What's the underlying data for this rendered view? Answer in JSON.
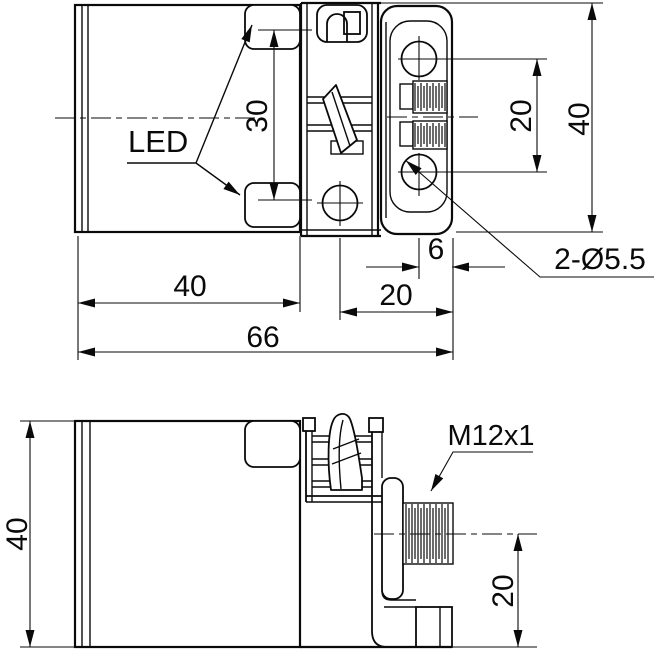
{
  "drawing": {
    "type": "sensor-dimensional-drawing",
    "ink_color": "#0a0a0a",
    "paper_color": "#ffffff",
    "top_view": {
      "led_label": "LED",
      "dims": {
        "led_spacing": "30",
        "hole_spacing": "20",
        "overall_height": "40",
        "hole_edge_offset": "6",
        "bracket_length": "20",
        "body_length": "40",
        "overall_length": "66"
      },
      "callouts": {
        "mounting_holes": "2-Ø5.5"
      }
    },
    "side_view": {
      "dims": {
        "overall_height": "40",
        "connector_center_height": "20"
      },
      "callouts": {
        "connector_thread": "M12x1"
      }
    }
  }
}
